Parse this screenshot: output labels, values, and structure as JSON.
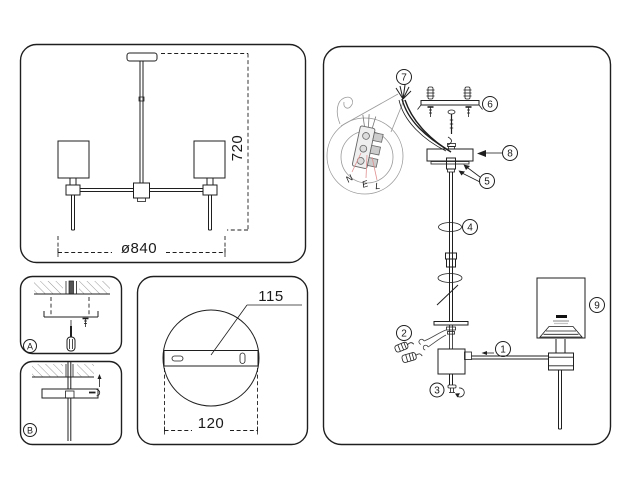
{
  "title": "lamp-assembly-instruction-diagram",
  "dims": {
    "height": "720",
    "diameter": "ø840",
    "bracket_length": "115",
    "plate_width": "120"
  },
  "steps": {
    "a": "A",
    "b": "B"
  },
  "assembly": {
    "callouts": {
      "c1": "1",
      "c2": "2",
      "c3": "3",
      "c4": "4",
      "c5": "5",
      "c6": "6",
      "c7": "7",
      "c8": "8",
      "c9": "9"
    },
    "wiring": {
      "n": "N",
      "e": "E",
      "l": "L"
    }
  },
  "colors": {
    "line": "#1f1f1f",
    "detail_line": "#9a9a9a",
    "wire_leader": "#e09090",
    "anchor_fill": "#555555"
  }
}
